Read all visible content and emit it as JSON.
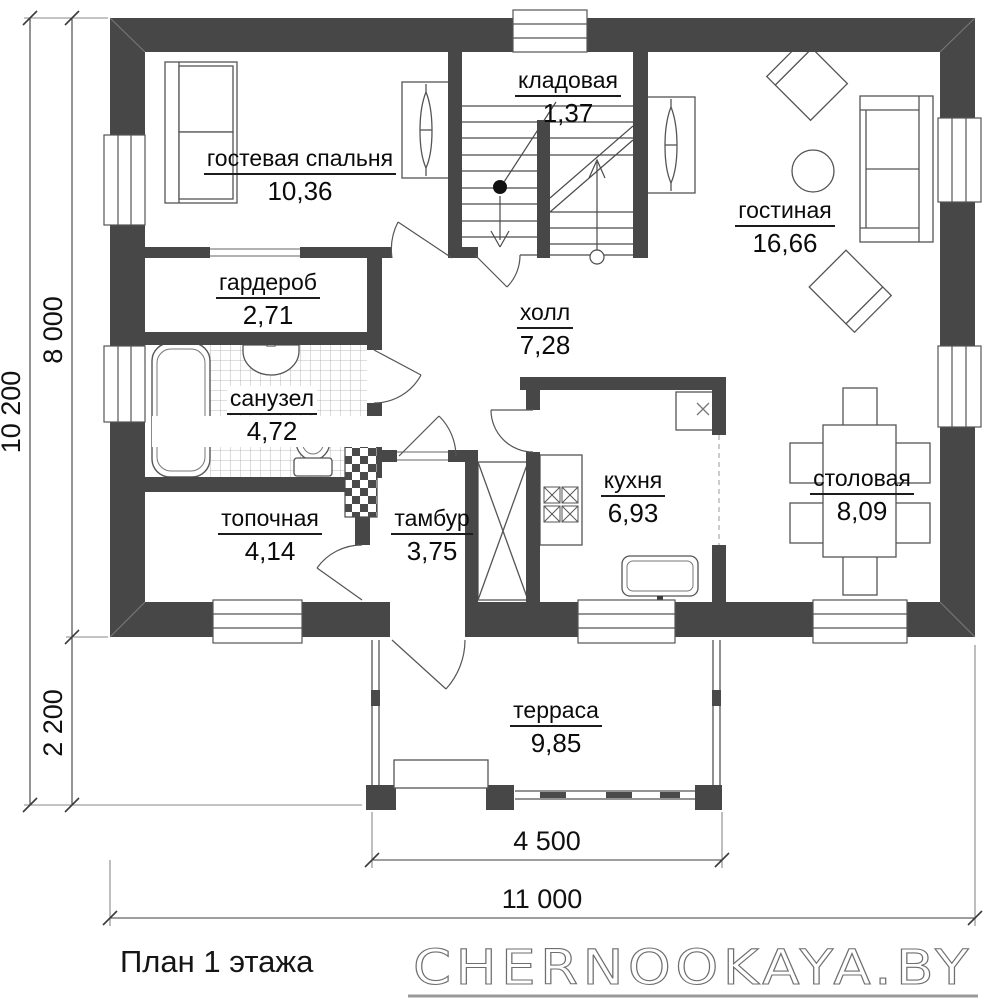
{
  "plan": {
    "title": "План 1 этажа",
    "brand": "CHERNOOKAYA.BY",
    "rooms": [
      {
        "id": "guest-bedroom",
        "name": "гостевая спальня",
        "area": "10,36"
      },
      {
        "id": "storage",
        "name": "кладовая",
        "area": "1,37"
      },
      {
        "id": "living-room",
        "name": "гостиная",
        "area": "16,66"
      },
      {
        "id": "wardrobe",
        "name": "гардероб",
        "area": "2,71"
      },
      {
        "id": "hall",
        "name": "холл",
        "area": "7,28"
      },
      {
        "id": "bathroom",
        "name": "санузел",
        "area": "4,72"
      },
      {
        "id": "boiler-room",
        "name": "топочная",
        "area": "4,14"
      },
      {
        "id": "vestibule",
        "name": "тамбур",
        "area": "3,75"
      },
      {
        "id": "kitchen",
        "name": "кухня",
        "area": "6,93"
      },
      {
        "id": "dining-room",
        "name": "столовая",
        "area": "8,09"
      },
      {
        "id": "terrace",
        "name": "терраса",
        "area": "9,85"
      }
    ],
    "dimensions": {
      "total_height": "10 200",
      "house_height": "8 000",
      "terrace_height": "2 200",
      "terrace_width": "4 500",
      "total_width": "11 000"
    },
    "colors": {
      "wall": "#474747",
      "line": "#555555"
    }
  }
}
